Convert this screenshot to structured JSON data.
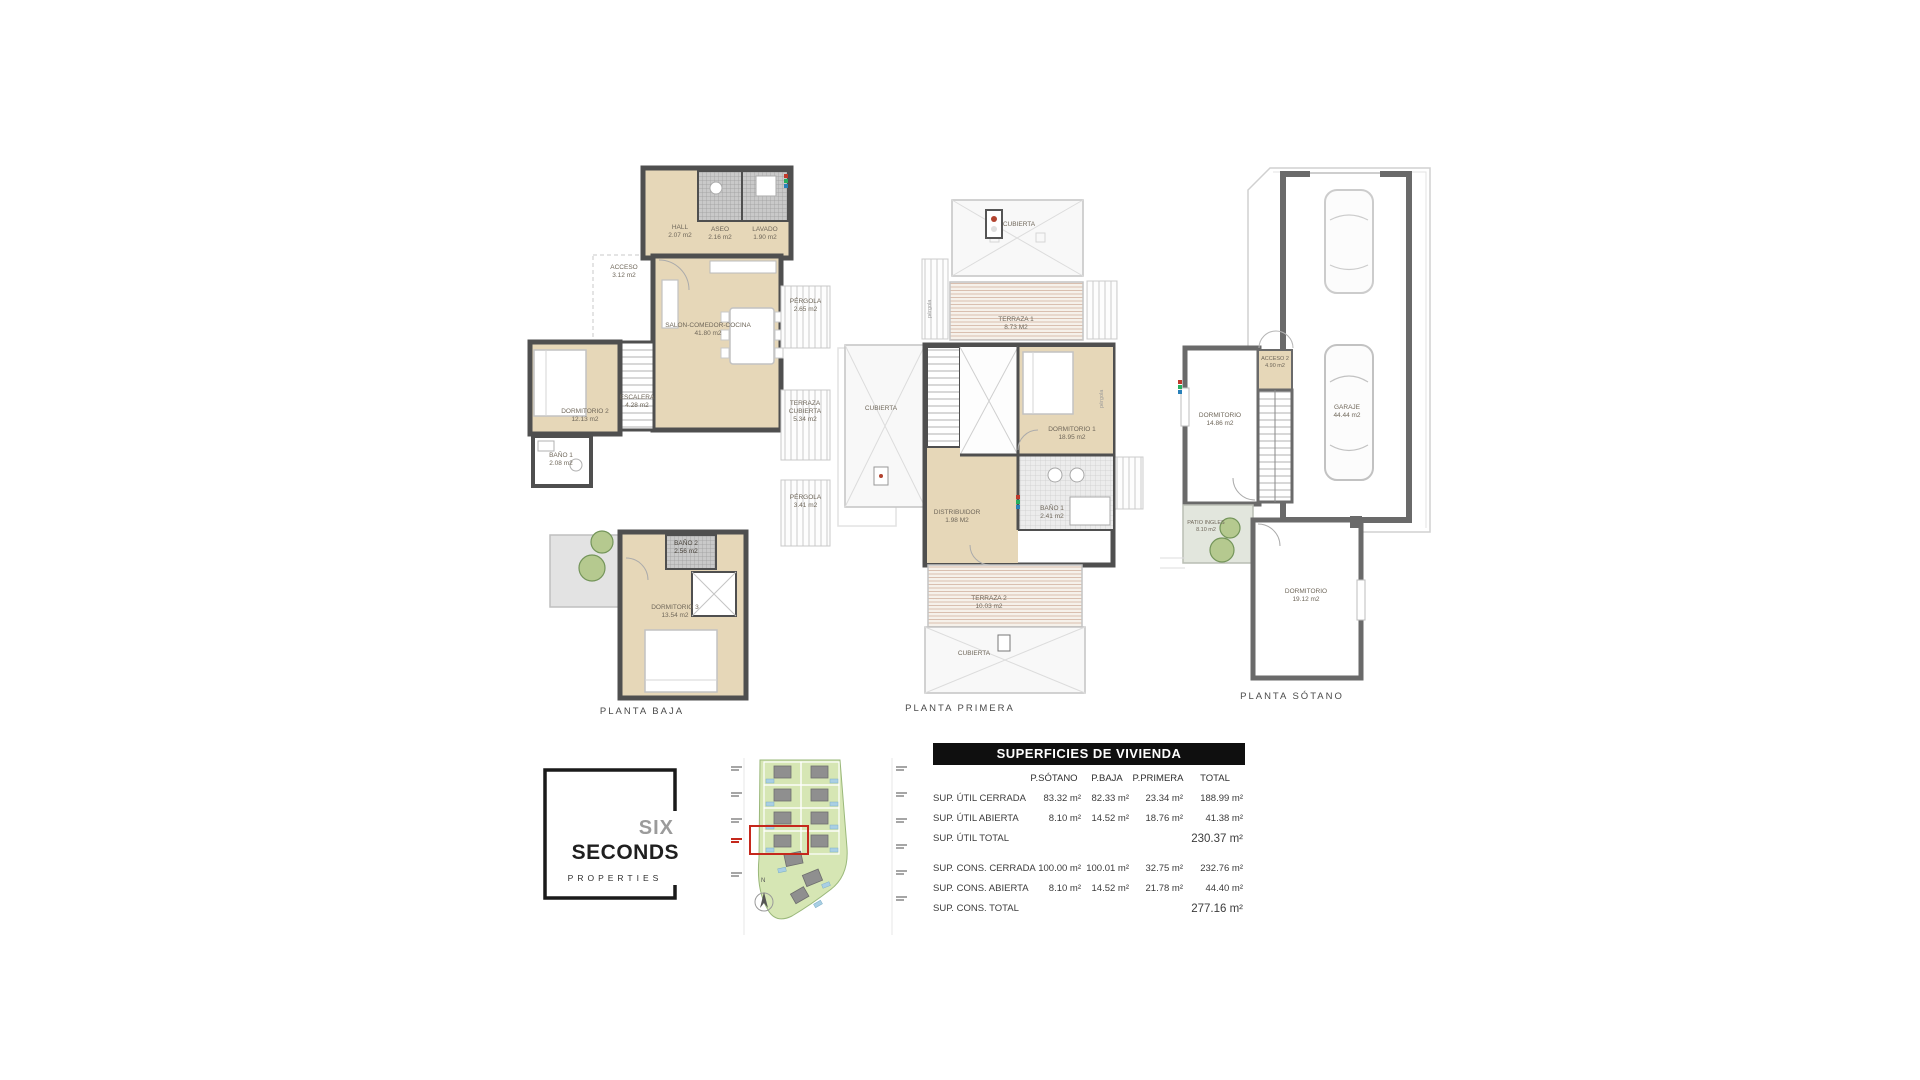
{
  "plans": {
    "baja": {
      "caption": "PLANTA BAJA",
      "rooms": {
        "hall": {
          "name": "HALL",
          "area": "2.07 m2"
        },
        "aseo": {
          "name": "ASEO",
          "area": "2.16 m2"
        },
        "lavado": {
          "name": "LAVADO",
          "area": "1.90 m2"
        },
        "acceso": {
          "name": "ACCESO",
          "area": "3.12 m2"
        },
        "salon": {
          "name": "SALON-COMEDOR-COCINA",
          "area": "41.80 m2"
        },
        "pergola1": {
          "name": "PÉRGOLA",
          "area": "2.65 m2"
        },
        "escalera": {
          "name": "ESCALERA",
          "area": "4.28 m2"
        },
        "dormitorio2": {
          "name": "DORMITORIO 2",
          "area": "12.13 m2"
        },
        "terraza_cubierta": {
          "name": "TERRAZA CUBIERTA",
          "area": "5.34 m2"
        },
        "bano1": {
          "name": "BAÑO 1",
          "area": "2.08 m2"
        },
        "pergola2": {
          "name": "PÉRGOLA",
          "area": "3.41 m2"
        },
        "bano2": {
          "name": "BAÑO 2",
          "area": "2.56 m2"
        },
        "dormitorio3": {
          "name": "DORMITORIO 3",
          "area": "13.54 m2"
        }
      }
    },
    "primera": {
      "caption": "PLANTA PRIMERA",
      "rooms": {
        "cubierta_top": {
          "name": "CUBIERTA"
        },
        "terraza1": {
          "name": "TERRAZA 1",
          "area": "8.73 M2"
        },
        "pergola_left": {
          "name": "pérgola"
        },
        "pergola_right": {
          "name": "pérgola"
        },
        "cubierta_left": {
          "name": "CUBIERTA"
        },
        "dormitorio1": {
          "name": "DORMITORIO 1",
          "area": "18.95 m2"
        },
        "distribuidor": {
          "name": "DISTRIBUIDOR",
          "area": "1.98 M2"
        },
        "bano1": {
          "name": "BAÑO 1",
          "area": "2.41 m2"
        },
        "terraza2": {
          "name": "TERRAZA 2",
          "area": "10.03 m2"
        },
        "cubierta_bottom": {
          "name": "CUBIERTA"
        }
      }
    },
    "sotano": {
      "caption": "PLANTA SÓTANO",
      "rooms": {
        "dormitorio_a": {
          "name": "DORMITORIO",
          "area": "14.86 m2"
        },
        "acceso2": {
          "name": "ACCESO 2",
          "area": "4.90 m2"
        },
        "garaje": {
          "name": "GARAJE",
          "area": "44.44 m2"
        },
        "patio_ingles": {
          "name": "PATIO INGLES",
          "area": "8.10 m2"
        },
        "dormitorio_b": {
          "name": "DORMITORIO",
          "area": "19.12 m2"
        }
      }
    }
  },
  "logo": {
    "line1": "SIX",
    "line2": "SECONDS",
    "line3": "PROPERTIES"
  },
  "siteplan": {
    "compass_north": "N",
    "highlight_color": "#c5281c"
  },
  "table": {
    "title": "SUPERFICIES DE VIVIENDA",
    "columns": {
      "c1": "P.SÓTANO",
      "c2": "P.BAJA",
      "c3": "P.PRIMERA",
      "c4": "TOTAL"
    },
    "rows": [
      {
        "label": "SUP. ÚTIL CERRADA",
        "v1": "83.32 m²",
        "v2": "82.33 m²",
        "v3": "23.34 m²",
        "v4": "188.99 m²"
      },
      {
        "label": "SUP. ÚTIL ABIERTA",
        "v1": "8.10 m²",
        "v2": "14.52 m²",
        "v3": "18.76 m²",
        "v4": "41.38 m²"
      },
      {
        "label": "SUP. ÚTIL TOTAL",
        "v1": "",
        "v2": "",
        "v3": "",
        "v4": "230.37 m²"
      },
      {
        "label": "SUP. CONS. CERRADA",
        "v1": "100.00 m²",
        "v2": "100.01 m²",
        "v3": "32.75 m²",
        "v4": "232.76 m²"
      },
      {
        "label": "SUP. CONS. ABIERTA",
        "v1": "8.10 m²",
        "v2": "14.52 m²",
        "v3": "21.78 m²",
        "v4": "44.40 m²"
      },
      {
        "label": "SUP. CONS. TOTAL",
        "v1": "",
        "v2": "",
        "v3": "",
        "v4": "277.16 m²"
      }
    ]
  },
  "colors": {
    "wall": "#4f4f4f",
    "wall_sotano": "#6a6a6a",
    "floor_beige": "#e6d7b8",
    "roof": "#f8f8f8",
    "site_green": "#d6e6b4",
    "pool_blue": "#a9cfe4",
    "table_header_bg": "#0f0f0f",
    "highlight_red": "#c5281c"
  }
}
